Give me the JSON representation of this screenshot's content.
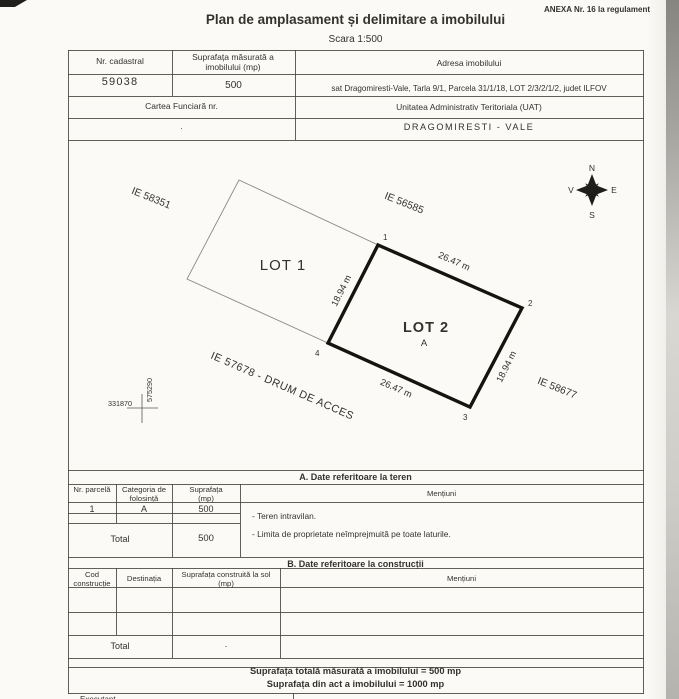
{
  "page": {
    "annex": "ANEXA Nr. 16  la regulament",
    "title": "Plan de amplasament și delimitare a imobilului",
    "scale": "Scara  1:500"
  },
  "header": {
    "nr_cadastral_label": "Nr. cadastral",
    "nr_cadastral_value": "59038",
    "suprafata_label": "Suprafața măsurată a imobilului (mp)",
    "suprafata_value": "500",
    "adresa_label": "Adresa imobilului",
    "adresa_value": "sat Dragomiresti-Vale, Tarla 9/1,  Parcela 31/1/18, LOT 2/3/2/1/2,  judet ILFOV",
    "cartea_funciara_label": "Cartea Funciară nr.",
    "cartea_funciara_value": ".",
    "uat_label": "Unitatea Administrativ Teritoriala (UAT)",
    "uat_value": "DRAGOMIRESTI - VALE"
  },
  "plan": {
    "lot1": "LOT 1",
    "lot2": "LOT 2",
    "lot2_category": "A",
    "dim_top": "26.47 m",
    "dim_bottom": "26.47 m",
    "dim_left": "18.94 m",
    "dim_right": "18.94 m",
    "corners": [
      "1",
      "2",
      "3",
      "4"
    ],
    "neighbor_nw": "IE 58351",
    "neighbor_ne": "IE 56585",
    "neighbor_sw": "IE 57678 - DRUM DE ACCES",
    "neighbor_se": "IE 58677",
    "grid_x": "331870",
    "grid_y": "575290",
    "compass": {
      "n": "N",
      "s": "S",
      "e": "E",
      "w": "V"
    }
  },
  "section_a": {
    "title": "A. Date referitoare la teren",
    "col_parcela": "Nr. parcelă",
    "col_categoria": "Categoria de folosință",
    "col_suprafata": "Suprafața (mp)",
    "col_mentiuni": "Mențiuni",
    "row1": {
      "parcela": "1",
      "categoria": "A",
      "suprafata": "500"
    },
    "mentiuni": [
      "- Teren intravilan.",
      "- Limita de proprietate neîmprejmuită pe toate laturile."
    ],
    "total_label": "Total",
    "total_value": "500"
  },
  "section_b": {
    "title": "B. Date referitoare la construcții",
    "col_cod": "Cod construcție",
    "col_destinatia": "Destinația",
    "col_suprafata": "Suprafața construită la sol (mp)",
    "col_mentiuni": "Mențiuni",
    "total_label": "Total",
    "total_value": "."
  },
  "summary": {
    "measured": "Suprafața totală măsurată a imobilului = 500 mp",
    "act": "Suprafața din act a imobilului = 1000 mp",
    "executant": "Executant,"
  }
}
